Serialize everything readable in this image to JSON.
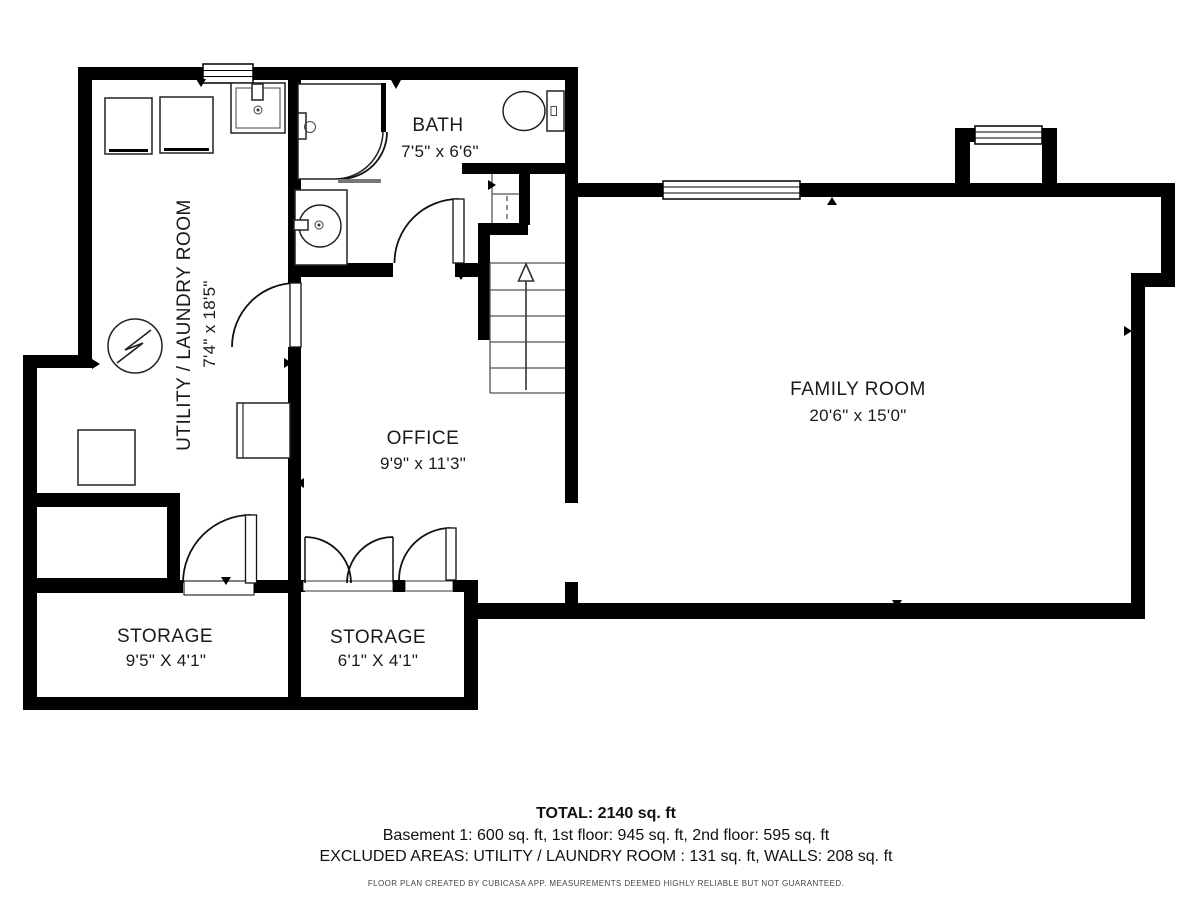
{
  "plan": {
    "type": "basement floor plan",
    "colors": {
      "wall": "#000000",
      "text": "#1a1a1a",
      "threshold": "#777777",
      "background": "#ffffff"
    }
  },
  "rooms": {
    "bath": {
      "name": "BATH",
      "dims": "7'5\" x 6'6\""
    },
    "family_room": {
      "name": "FAMILY ROOM",
      "dims": "20'6\" x 15'0\""
    },
    "office": {
      "name": "OFFICE",
      "dims": "9'9\" x 11'3\""
    },
    "utility": {
      "name": "UTILITY / LAUNDRY ROOM",
      "dims": "7'4\" x 18'5\""
    },
    "storage_left": {
      "name": "STORAGE",
      "dims": "9'5\" X 4'1\""
    },
    "storage_mid": {
      "name": "STORAGE",
      "dims": "6'1\" X 4'1\""
    }
  },
  "footer": {
    "total": "TOTAL: 2140 sq. ft",
    "floors": "Basement 1: 600 sq. ft, 1st floor: 945 sq. ft, 2nd floor: 595 sq. ft",
    "excluded": "EXCLUDED AREAS: UTILITY / LAUNDRY ROOM : 131 sq. ft, WALLS: 208 sq. ft",
    "disclaimer": "FLOOR PLAN CREATED BY CUBICASA APP. MEASUREMENTS DEEMED HIGHLY RELIABLE BUT NOT GUARANTEED."
  }
}
